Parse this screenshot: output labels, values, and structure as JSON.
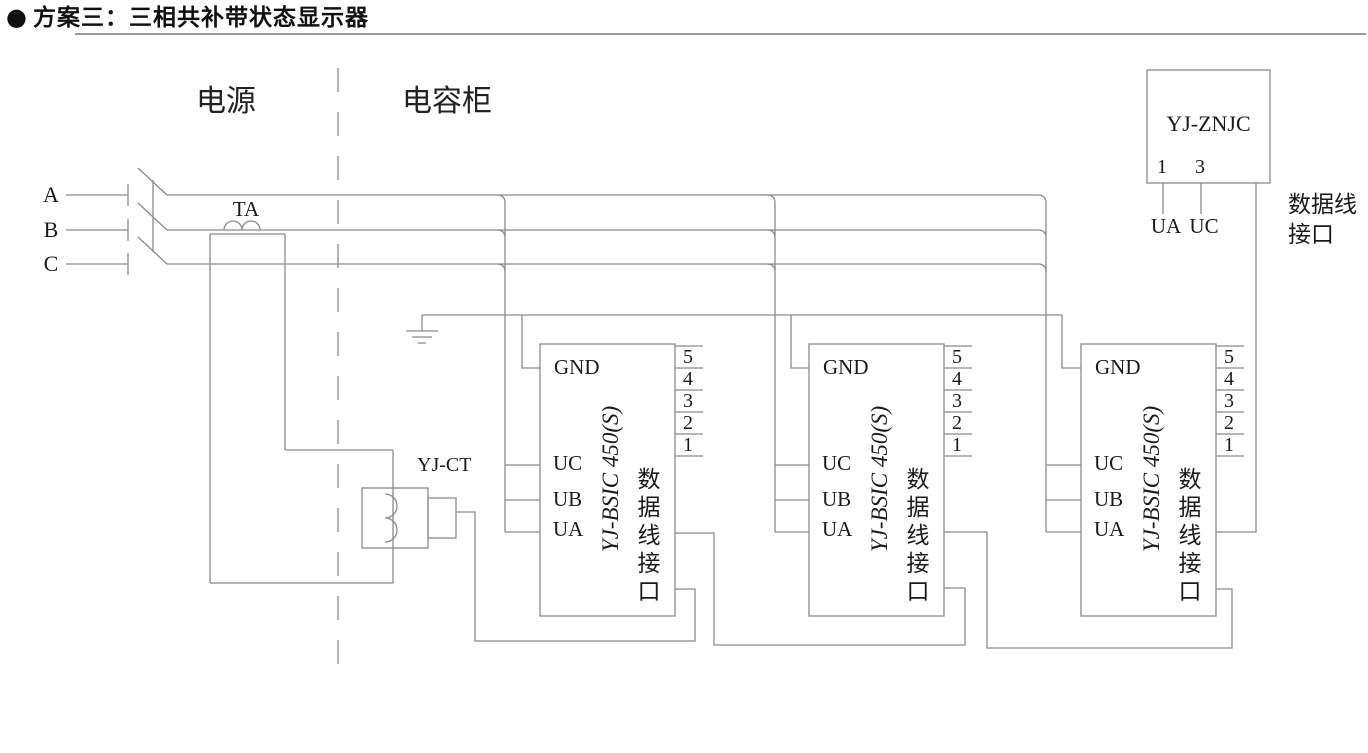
{
  "title": {
    "bullet": "●",
    "text": "方案三：三相共补带状态显示器"
  },
  "zones": {
    "power": "电源",
    "capacitor": "电容柜"
  },
  "phases": {
    "a": "A",
    "b": "B",
    "c": "C"
  },
  "labels": {
    "ta": "TA",
    "yj_ct": "YJ-CT"
  },
  "icons": {
    "ground": "earth-ground-icon",
    "breaker": "three-pole-breaker-icon",
    "ta_coil": "current-transformer-coil-icon",
    "ct_clamp": "ct-clamp-icon"
  },
  "colors": {
    "wire": "#8a8a8a",
    "text": "#1a1a1a",
    "rule": "#9a9a9a"
  },
  "controller": {
    "model": "YJ-ZNJC",
    "pin_left": "1",
    "pin_right": "3",
    "pin_left_label": "UA",
    "pin_right_label": "UC",
    "port_line1": "数据线",
    "port_line2": "接口"
  },
  "units": [
    {
      "model": "YJ-BSIC 450(S)",
      "gnd": "GND",
      "uc": "UC",
      "ub": "UB",
      "ua": "UA",
      "pins": [
        "5",
        "4",
        "3",
        "2",
        "1"
      ],
      "port": "数据线接口"
    },
    {
      "model": "YJ-BSIC 450(S)",
      "gnd": "GND",
      "uc": "UC",
      "ub": "UB",
      "ua": "UA",
      "pins": [
        "5",
        "4",
        "3",
        "2",
        "1"
      ],
      "port": "数据线接口"
    },
    {
      "model": "YJ-BSIC 450(S)",
      "gnd": "GND",
      "uc": "UC",
      "ub": "UB",
      "ua": "UA",
      "pins": [
        "5",
        "4",
        "3",
        "2",
        "1"
      ],
      "port": "数据线接口"
    }
  ]
}
